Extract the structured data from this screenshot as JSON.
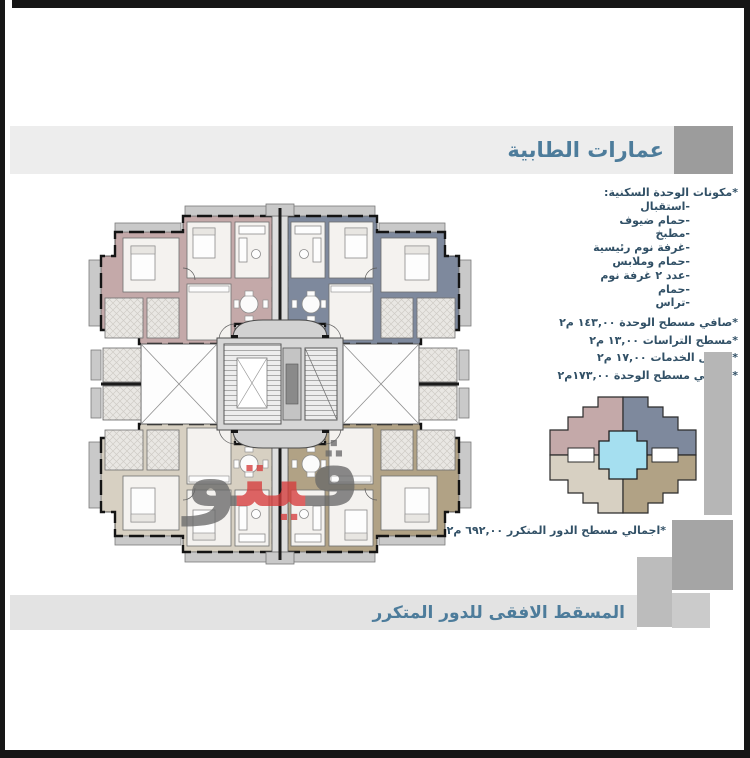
{
  "header": {
    "title": "عمارات الطابية",
    "text_color": "#4d7c9b"
  },
  "unit_components": {
    "heading": "*مكونات الوحدة السكنية:",
    "items": [
      "-استقبال",
      "-حمام ضيوف",
      "-مطبخ",
      "-غرفة نوم رئيسية",
      "-حمام وملابس",
      "-عدد ٢ غرفة نوم",
      "-حمام",
      "-تراس"
    ]
  },
  "unit_areas": {
    "items": [
      "*صافي مسطح الوحدة ١٤٣,٠٠ م٢",
      "*مسطح التراسات ١٣,٠٠ م٢",
      "*تحميل الخدمات ١٧,٠٠ م٢",
      "*اجمالي مسطح الوحدة ١٧٣,٠٠م٢"
    ]
  },
  "typical_floor_total": "*اجمالي مسطح الدور المتكرر ٦٩٢,٠٠ م٢",
  "footer": {
    "title": "المسقط الافقى للدور المتكرر"
  },
  "watermark": {
    "part_right": "ڤ",
    "part_middle": "يت",
    "part_left": "و",
    "gray": "#6a6a6a",
    "red": "#d63c3c"
  },
  "plan_colors": {
    "top_left": "#c4a9a9",
    "top_right": "#7e899d",
    "bottom_left": "#d7d0c2",
    "bottom_right": "#b1a285",
    "core_gray": "#d6d6d6",
    "balcony_gray": "#c9c9c9",
    "room_white": "#f4f2ef",
    "accent_red": "#d23535",
    "key_center_cyan": "#a5dff0"
  }
}
